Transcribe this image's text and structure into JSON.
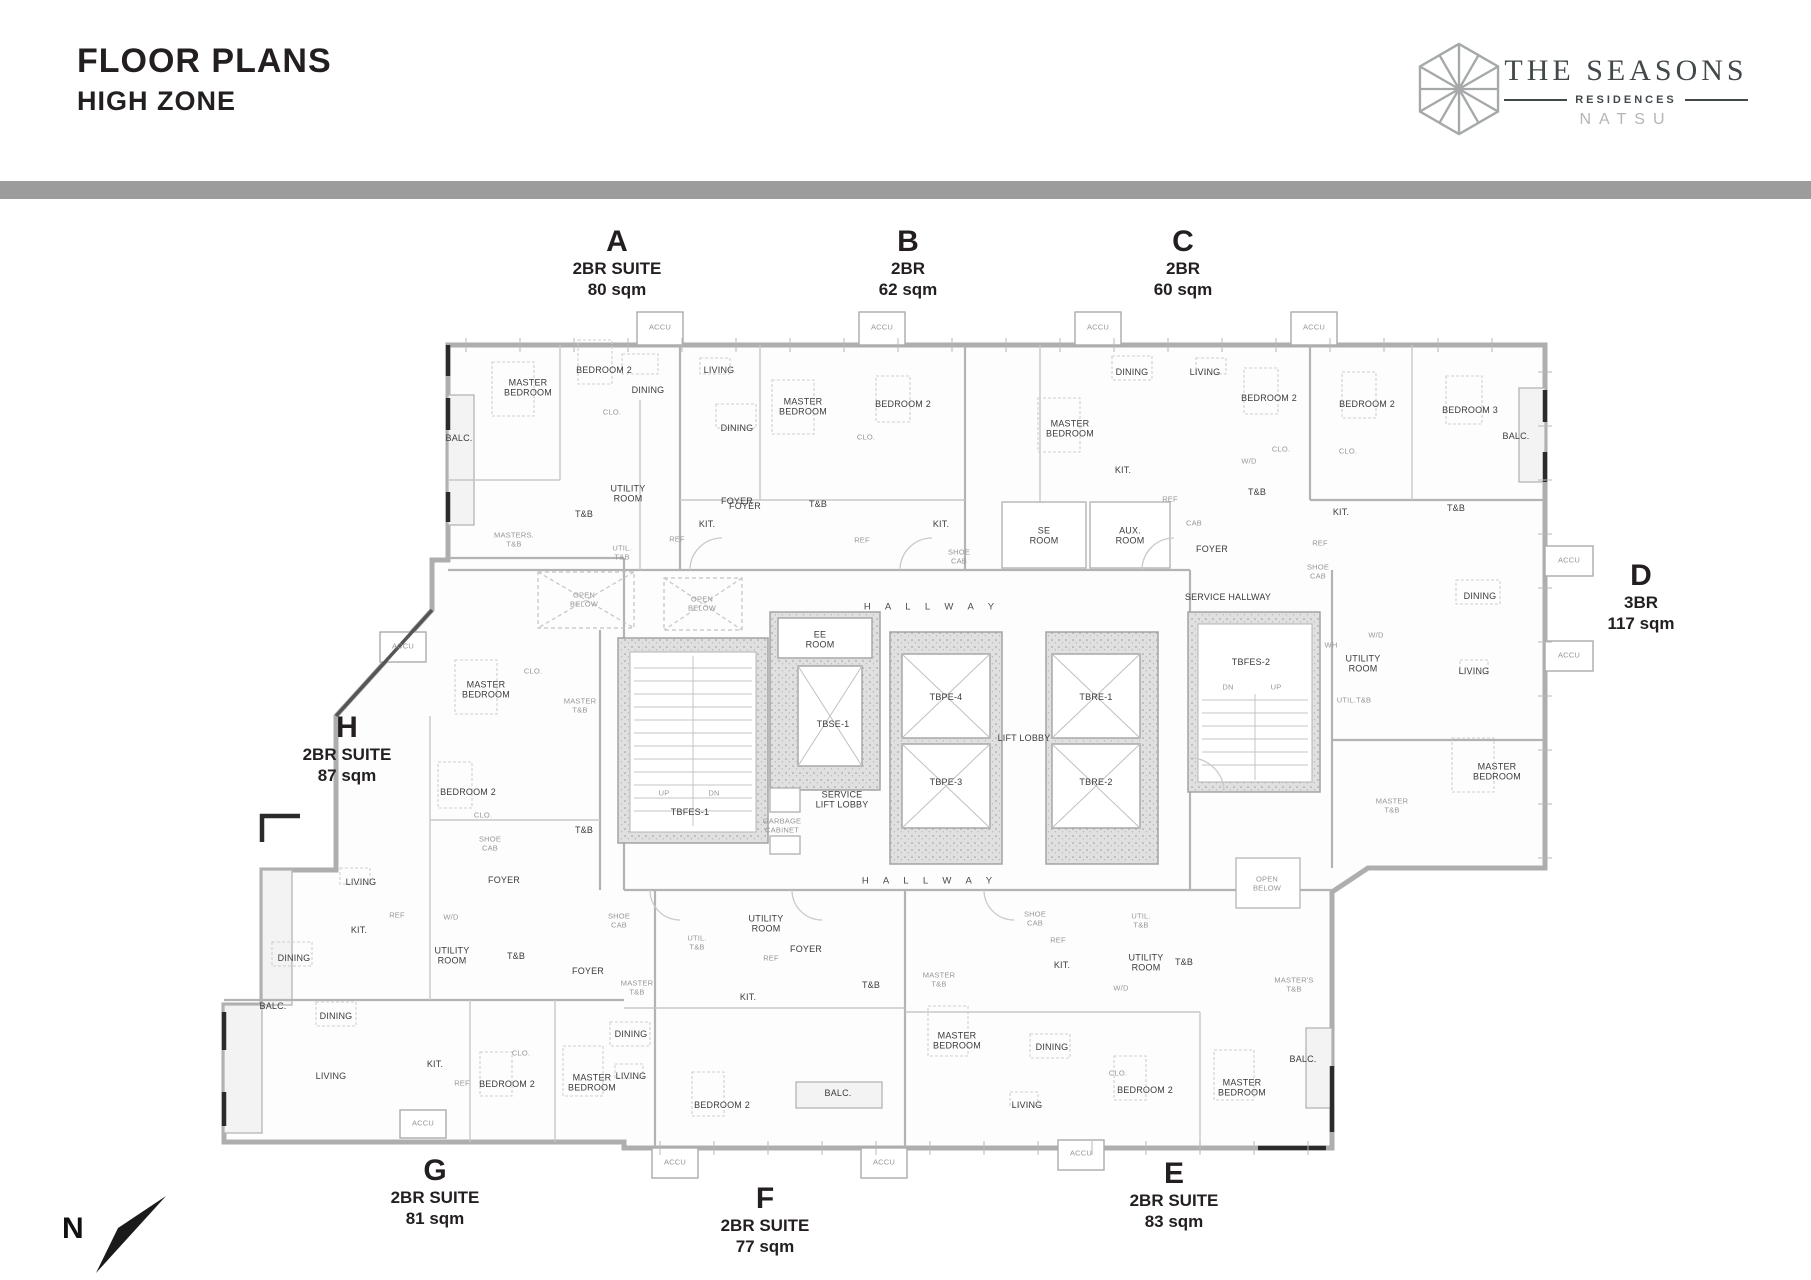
{
  "header": {
    "title": "FLOOR PLANS",
    "subtitle": "HIGH ZONE"
  },
  "brand": {
    "name": "THE SEASONS",
    "division": "RESIDENCES",
    "project": "NATSU",
    "logo_icon": "asanoha-hexagon"
  },
  "north_label": "N",
  "colors": {
    "divider_gray": "#9c9c9c",
    "ink": "#231f20",
    "logo_gray": "#a5a9a9",
    "logo_text": "#43494b",
    "natsu_gray": "#b2b6b6",
    "plan_line": "#b0b0b0",
    "plan_text": "#3b3b3b"
  },
  "plan": {
    "units": [
      {
        "id": "A",
        "type": "2BR SUITE",
        "area": "80 sqm",
        "x": 617,
        "y": 226
      },
      {
        "id": "B",
        "type": "2BR",
        "area": "62 sqm",
        "x": 908,
        "y": 226
      },
      {
        "id": "C",
        "type": "2BR",
        "area": "60 sqm",
        "x": 1183,
        "y": 226
      },
      {
        "id": "D",
        "type": "3BR",
        "area": "117 sqm",
        "x": 1641,
        "y": 560
      },
      {
        "id": "E",
        "type": "2BR SUITE",
        "area": "83 sqm",
        "x": 1174,
        "y": 1158
      },
      {
        "id": "F",
        "type": "2BR SUITE",
        "area": "77 sqm",
        "x": 765,
        "y": 1183
      },
      {
        "id": "G",
        "type": "2BR SUITE",
        "area": "81 sqm",
        "x": 435,
        "y": 1155
      },
      {
        "id": "H",
        "type": "2BR SUITE",
        "area": "87 sqm",
        "x": 347,
        "y": 712
      }
    ],
    "rooms": [
      {
        "t": "ACCU",
        "x": 660,
        "y": 328,
        "s": 1
      },
      {
        "t": "MASTER\nBEDROOM",
        "x": 528,
        "y": 388
      },
      {
        "t": "BEDROOM 2",
        "x": 604,
        "y": 370
      },
      {
        "t": "DINING",
        "x": 648,
        "y": 390
      },
      {
        "t": "CLO.",
        "x": 612,
        "y": 413,
        "s": 1
      },
      {
        "t": "BALC.",
        "x": 459,
        "y": 438
      },
      {
        "t": "UTILITY\nROOM",
        "x": 628,
        "y": 494
      },
      {
        "t": "T&B",
        "x": 584,
        "y": 514
      },
      {
        "t": "KIT.",
        "x": 707,
        "y": 524
      },
      {
        "t": "FOYER",
        "x": 745,
        "y": 506
      },
      {
        "t": "UTIL.\nT&B",
        "x": 622,
        "y": 553,
        "s": 1
      },
      {
        "t": "REF",
        "x": 677,
        "y": 540,
        "s": 1
      },
      {
        "t": "MASTERS.\nT&B",
        "x": 514,
        "y": 540,
        "s": 1
      },
      {
        "t": "ACCU",
        "x": 882,
        "y": 328,
        "s": 1
      },
      {
        "t": "LIVING",
        "x": 719,
        "y": 370
      },
      {
        "t": "DINING",
        "x": 737,
        "y": 428
      },
      {
        "t": "MASTER\nBEDROOM",
        "x": 803,
        "y": 407
      },
      {
        "t": "BEDROOM 2",
        "x": 903,
        "y": 404
      },
      {
        "t": "CLO.",
        "x": 866,
        "y": 438,
        "s": 1
      },
      {
        "t": "FOYER",
        "x": 737,
        "y": 501
      },
      {
        "t": "T&B",
        "x": 818,
        "y": 504
      },
      {
        "t": "KIT.",
        "x": 941,
        "y": 524
      },
      {
        "t": "REF",
        "x": 862,
        "y": 541,
        "s": 1
      },
      {
        "t": "SHOE\nCAB",
        "x": 959,
        "y": 557,
        "s": 1
      },
      {
        "t": "ACCU",
        "x": 1098,
        "y": 328,
        "s": 1
      },
      {
        "t": "DINING",
        "x": 1132,
        "y": 372
      },
      {
        "t": "LIVING",
        "x": 1205,
        "y": 372
      },
      {
        "t": "MASTER\nBEDROOM",
        "x": 1070,
        "y": 429
      },
      {
        "t": "BEDROOM 2",
        "x": 1269,
        "y": 398
      },
      {
        "t": "KIT.",
        "x": 1123,
        "y": 470
      },
      {
        "t": "REF",
        "x": 1170,
        "y": 500,
        "s": 1
      },
      {
        "t": "W/D",
        "x": 1249,
        "y": 462,
        "s": 1
      },
      {
        "t": "T&B",
        "x": 1257,
        "y": 492
      },
      {
        "t": "CLO.",
        "x": 1281,
        "y": 450,
        "s": 1
      },
      {
        "t": "ACCU",
        "x": 1314,
        "y": 328,
        "s": 1
      },
      {
        "t": "BEDROOM 2",
        "x": 1367,
        "y": 404
      },
      {
        "t": "BEDROOM 3",
        "x": 1470,
        "y": 410
      },
      {
        "t": "CLO.",
        "x": 1348,
        "y": 452,
        "s": 1
      },
      {
        "t": "BALC.",
        "x": 1516,
        "y": 436
      },
      {
        "t": "KIT.",
        "x": 1341,
        "y": 512
      },
      {
        "t": "T&B",
        "x": 1456,
        "y": 508
      },
      {
        "t": "SE\nROOM",
        "x": 1044,
        "y": 536
      },
      {
        "t": "AUX.\nROOM",
        "x": 1130,
        "y": 536
      },
      {
        "t": "SERVICE HALLWAY",
        "x": 1228,
        "y": 597
      },
      {
        "t": "CAB",
        "x": 1194,
        "y": 524,
        "s": 1
      },
      {
        "t": "FOYER",
        "x": 1212,
        "y": 549
      },
      {
        "t": "REF",
        "x": 1320,
        "y": 544,
        "s": 1
      },
      {
        "t": "SHOE\nCAB",
        "x": 1318,
        "y": 572,
        "s": 1
      },
      {
        "t": "DINING",
        "x": 1480,
        "y": 596
      },
      {
        "t": "LIVING",
        "x": 1474,
        "y": 671
      },
      {
        "t": "UTILITY\nROOM",
        "x": 1363,
        "y": 664
      },
      {
        "t": "UTIL.T&B",
        "x": 1354,
        "y": 701,
        "s": 1
      },
      {
        "t": "WH",
        "x": 1331,
        "y": 646,
        "s": 1
      },
      {
        "t": "W/D",
        "x": 1376,
        "y": 636,
        "s": 1
      },
      {
        "t": "MASTER\nBEDROOM",
        "x": 1497,
        "y": 772
      },
      {
        "t": "MASTER\nT&B",
        "x": 1392,
        "y": 806,
        "s": 1
      },
      {
        "t": "TBFES-2",
        "x": 1251,
        "y": 662
      },
      {
        "t": "DN",
        "x": 1228,
        "y": 688,
        "s": 1
      },
      {
        "t": "UP",
        "x": 1276,
        "y": 688,
        "s": 1
      },
      {
        "t": "ACCU",
        "x": 1569,
        "y": 561,
        "s": 1
      },
      {
        "t": "ACCU",
        "x": 1569,
        "y": 656,
        "s": 1
      },
      {
        "t": "OPEN\nBELOW",
        "x": 1267,
        "y": 884,
        "s": 1
      },
      {
        "t": "H A L L W A Y",
        "x": 932,
        "y": 608,
        "sp": 1
      },
      {
        "t": "H A L L W A Y",
        "x": 930,
        "y": 882,
        "sp": 1
      },
      {
        "t": "EE\nROOM",
        "x": 820,
        "y": 640
      },
      {
        "t": "TBSE-1",
        "x": 833,
        "y": 724
      },
      {
        "t": "SERVICE\nLIFT LOBBY",
        "x": 842,
        "y": 800
      },
      {
        "t": "GARBAGE\nCABINET",
        "x": 782,
        "y": 826,
        "s": 1
      },
      {
        "t": "TBFES-1",
        "x": 690,
        "y": 812
      },
      {
        "t": "UP",
        "x": 664,
        "y": 794,
        "s": 1
      },
      {
        "t": "DN",
        "x": 714,
        "y": 794,
        "s": 1
      },
      {
        "t": "LIFT LOBBY",
        "x": 1024,
        "y": 738
      },
      {
        "t": "TBPE-4",
        "x": 946,
        "y": 697
      },
      {
        "t": "TBPE-3",
        "x": 946,
        "y": 782
      },
      {
        "t": "TBRE-1",
        "x": 1096,
        "y": 697
      },
      {
        "t": "TBRE-2",
        "x": 1096,
        "y": 782
      },
      {
        "t": "OPEN\nBELOW",
        "x": 584,
        "y": 600,
        "s": 1
      },
      {
        "t": "OPEN\nBELOW",
        "x": 702,
        "y": 604,
        "s": 1
      },
      {
        "t": "ACCU",
        "x": 403,
        "y": 647,
        "s": 1
      },
      {
        "t": "MASTER\nBEDROOM",
        "x": 486,
        "y": 690
      },
      {
        "t": "CLO.",
        "x": 533,
        "y": 672,
        "s": 1
      },
      {
        "t": "MASTER\nT&B",
        "x": 580,
        "y": 706,
        "s": 1
      },
      {
        "t": "BEDROOM 2",
        "x": 468,
        "y": 792
      },
      {
        "t": "CLO.",
        "x": 483,
        "y": 816,
        "s": 1
      },
      {
        "t": "SHOE\nCAB",
        "x": 490,
        "y": 844,
        "s": 1
      },
      {
        "t": "LIVING",
        "x": 361,
        "y": 882
      },
      {
        "t": "FOYER",
        "x": 504,
        "y": 880
      },
      {
        "t": "KIT.",
        "x": 359,
        "y": 930
      },
      {
        "t": "REF",
        "x": 397,
        "y": 916,
        "s": 1
      },
      {
        "t": "W/D",
        "x": 451,
        "y": 918,
        "s": 1
      },
      {
        "t": "DINING",
        "x": 294,
        "y": 958
      },
      {
        "t": "UTILITY\nROOM",
        "x": 452,
        "y": 956
      },
      {
        "t": "T&B",
        "x": 516,
        "y": 956
      },
      {
        "t": "T&B",
        "x": 584,
        "y": 830
      },
      {
        "t": "BALC.",
        "x": 273,
        "y": 1006
      },
      {
        "t": "DINING",
        "x": 336,
        "y": 1016
      },
      {
        "t": "LIVING",
        "x": 331,
        "y": 1076
      },
      {
        "t": "KIT.",
        "x": 435,
        "y": 1064
      },
      {
        "t": "REF",
        "x": 462,
        "y": 1084,
        "s": 1
      },
      {
        "t": "ACCU",
        "x": 423,
        "y": 1124,
        "s": 1
      },
      {
        "t": "BEDROOM 2",
        "x": 507,
        "y": 1084
      },
      {
        "t": "CLO.",
        "x": 521,
        "y": 1054,
        "s": 1
      },
      {
        "t": "MASTER\nBEDROOM",
        "x": 592,
        "y": 1083
      },
      {
        "t": "ACCU",
        "x": 675,
        "y": 1163,
        "s": 1
      },
      {
        "t": "FOYER",
        "x": 588,
        "y": 971
      },
      {
        "t": "MASTER\nT&B",
        "x": 637,
        "y": 988,
        "s": 1
      },
      {
        "t": "SHOE\nCAB",
        "x": 619,
        "y": 921,
        "s": 1
      },
      {
        "t": "UTIL.\nT&B",
        "x": 697,
        "y": 943,
        "s": 1
      },
      {
        "t": "UTILITY\nROOM",
        "x": 766,
        "y": 924
      },
      {
        "t": "REF",
        "x": 771,
        "y": 959,
        "s": 1
      },
      {
        "t": "KIT.",
        "x": 748,
        "y": 997
      },
      {
        "t": "DINING",
        "x": 631,
        "y": 1034
      },
      {
        "t": "LIVING",
        "x": 631,
        "y": 1076
      },
      {
        "t": "MASTER\nBEDROOM",
        "x": 957,
        "y": 1041
      },
      {
        "t": "BEDROOM 2",
        "x": 722,
        "y": 1105
      },
      {
        "t": "BALC.",
        "x": 838,
        "y": 1093
      },
      {
        "t": "T&B",
        "x": 871,
        "y": 985
      },
      {
        "t": "FOYER",
        "x": 806,
        "y": 949
      },
      {
        "t": "ACCU",
        "x": 884,
        "y": 1163,
        "s": 1
      },
      {
        "t": "SHOE\nCAB",
        "x": 1035,
        "y": 919,
        "s": 1
      },
      {
        "t": "REF",
        "x": 1058,
        "y": 941,
        "s": 1
      },
      {
        "t": "KIT.",
        "x": 1062,
        "y": 965
      },
      {
        "t": "UTIL.\nT&B",
        "x": 1141,
        "y": 921,
        "s": 1
      },
      {
        "t": "UTILITY\nROOM",
        "x": 1146,
        "y": 963
      },
      {
        "t": "T&B",
        "x": 1184,
        "y": 962
      },
      {
        "t": "W/D",
        "x": 1121,
        "y": 989,
        "s": 1
      },
      {
        "t": "MASTER\nT&B",
        "x": 939,
        "y": 980,
        "s": 1
      },
      {
        "t": "DINING",
        "x": 1052,
        "y": 1047
      },
      {
        "t": "LIVING",
        "x": 1027,
        "y": 1105
      },
      {
        "t": "CLO.",
        "x": 1118,
        "y": 1074,
        "s": 1
      },
      {
        "t": "BEDROOM 2",
        "x": 1145,
        "y": 1090
      },
      {
        "t": "MASTER\nBEDROOM",
        "x": 1242,
        "y": 1088
      },
      {
        "t": "MASTER'S\nT&B",
        "x": 1294,
        "y": 985,
        "s": 1
      },
      {
        "t": "BALC.",
        "x": 1303,
        "y": 1059
      },
      {
        "t": "ACCU",
        "x": 1081,
        "y": 1154,
        "s": 1
      }
    ]
  }
}
